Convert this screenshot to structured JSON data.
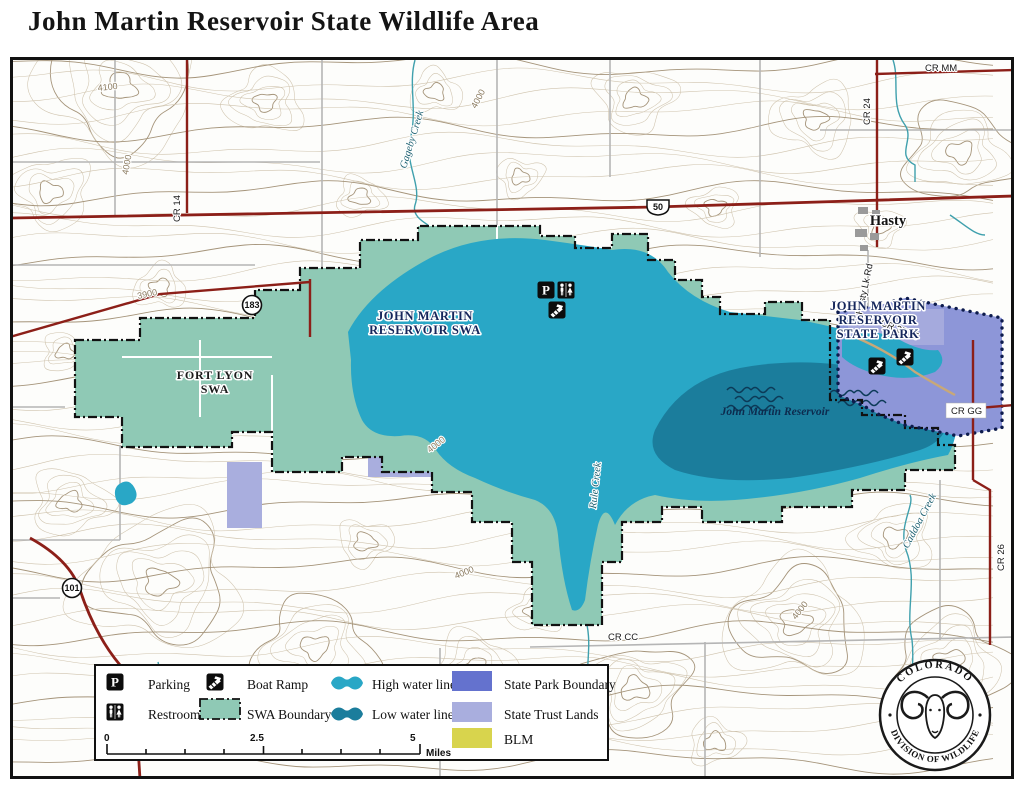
{
  "title": "John Martin Reservoir State Wildlife Area",
  "seal": {
    "top": "COLORADO",
    "bottom": "DIVISION OF WILDLIFE"
  },
  "legend": {
    "parking": "Parking",
    "restroom": "Restroom",
    "boat_ramp": "Boat Ramp",
    "swa_boundary": "SWA Boundary",
    "high_water": "High water line",
    "low_water": "Low water line",
    "state_park": "State Park Boundary",
    "trust_lands": "State Trust Lands",
    "blm": "BLM",
    "scale": {
      "zero": "0",
      "mid": "2.5",
      "end": "5",
      "unit": "Miles"
    }
  },
  "labels": {
    "swa1": "JOHN MARTIN",
    "swa2": "RESERVOIR SWA",
    "fort1": "FORT LYON",
    "fort2": "SWA",
    "park1": "JOHN MARTIN",
    "park2": "RESERVOIR",
    "park3": "STATE PARK",
    "reservoir": "John Martin Reservoir",
    "town_hasty": "Hasty"
  },
  "roads": {
    "us50": "50",
    "sh183": "183",
    "sh101": "101",
    "cr_mm": "CR MM",
    "cr_24": "CR 24",
    "cr_14": "CR 14",
    "cr_2575": "CR 25.75",
    "cr_gg": "CR GG",
    "cr_26": "CR 26",
    "cr_cc": "CR CC",
    "hasty_lk_rd": "Hasty Lk Rd"
  },
  "creeks": {
    "gageby": "Gageby Creek",
    "rule": "Rule Creek",
    "caddoa": "Caddoa Creek"
  },
  "contour_labels": {
    "c4100": "4100",
    "c4000": "4000",
    "c3900": "3900"
  },
  "icons": {
    "parking_letter": "P"
  },
  "colors": {
    "swa_fill": "#8fc9b5",
    "high_water": "#29a7c6",
    "low_water": "#1b7d9c",
    "state_park_fill": "#8d96d8",
    "state_park_legend": "#6472ce",
    "state_trust": "#a9aede",
    "blm": "#d8d44d",
    "highway_red": "#8c1f18",
    "contour_tan": "#cfc3ad",
    "navy_label": "#16275c"
  }
}
